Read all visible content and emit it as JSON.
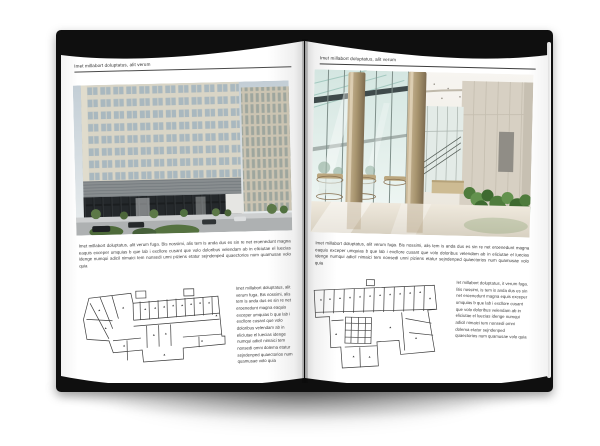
{
  "colors": {
    "background": "#ffffff",
    "cover": "#0f0f0f",
    "page": "#ffffff",
    "rule": "#4a4a4a",
    "text": "#3a3a3a"
  },
  "left_page": {
    "header": "Imet millabort doluptatus, alit verum",
    "body": "Imet millabort doluptatus, alit verum fuga. Bis nossimi, alis tem is anda dus es sin re net eroenedunt magna eaquis exceper umquias b que lab i excllore cusant que volo doloribus velendam ab in eliciutae el luecias idenge numqui adicil nimaici tem nonsedi unni piziens etatur sejndenped quaectorios num quamusae volo quia",
    "caption": "Imet millabort doluptatus, alit verum fuga. Bis nossimi, alis tem is anda dus es sin re net eroenedunt magna eaquis exceper umquias b que lab i excllore cusant que volo doloribus velendam ab in eliciutae el luecias idenge numqui adicil nimaici tem nonsedi omni dolema etatur sejndenped quaectorios num quamusae volo quia"
  },
  "right_page": {
    "header": "Imet millabort doluptatus, alit verum",
    "body": "Imet millabort doluptatus, alit verum fuga. Bis nossimi, alis tem is anda dus es sin re net eroenedunt magna eaquis exceper umquias b que lab i excllore cusant que volo doloribus velendam ab in eliciutae el luecias idenge numqui adicil nimaici tem nonsedi unni piziens etatur sejndenped quaectorios num quamusae volo quia",
    "caption": "Iet millabort doluptatus, it verum fuga. Bis nossimi, is tem is anda dus es sin net eroenedunt magna equis exceper umquias b que lab i excllore cusant que volo doloribus velendam ab in eliciutae el luecias idenge numqui adicil nimaici tem nonsedi omni dolema etatur sejndenped quaectorios num quamusae volo quia"
  }
}
